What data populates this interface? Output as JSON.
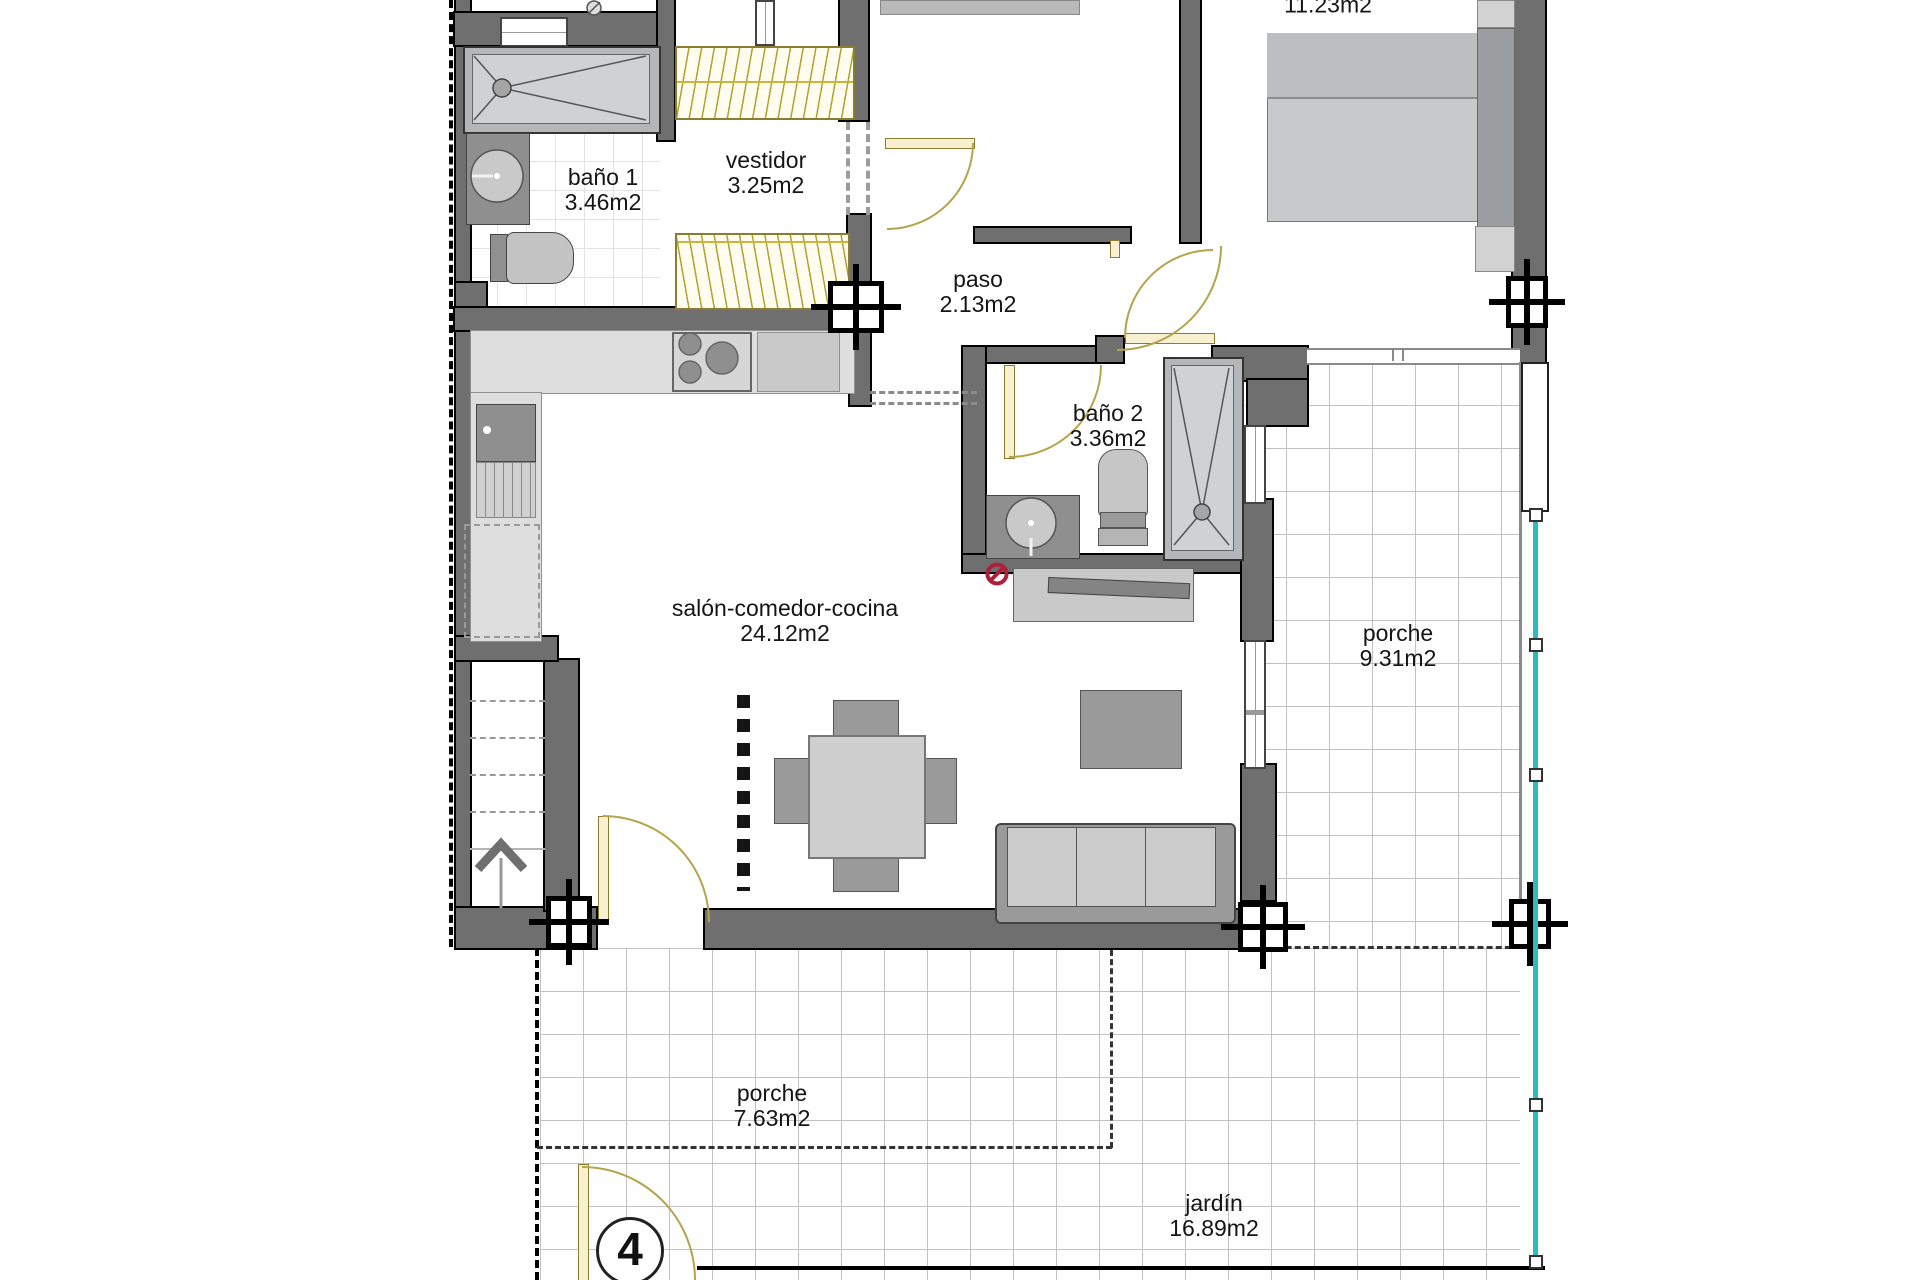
{
  "plan_title": "apartment floor plan",
  "rooms": {
    "bano1": {
      "name": "baño 1",
      "area": "3.46m2"
    },
    "vestidor": {
      "name": "vestidor",
      "area": "3.25m2"
    },
    "paso": {
      "name": "paso",
      "area": "2.13m2"
    },
    "dormitorio": {
      "area": "11.23m2"
    },
    "bano2": {
      "name": "baño 2",
      "area": "3.36m2"
    },
    "salon": {
      "name": "salón-comedor-cocina",
      "area": "24.12m2"
    },
    "porche_lateral": {
      "name": "porche",
      "area": "9.31m2"
    },
    "porche_frontal": {
      "name": "porche",
      "area": "7.63m2"
    },
    "jardin": {
      "name": "jardín",
      "area": "16.89m2"
    }
  },
  "unit_number": "4",
  "colors": {
    "wall": "#6f6f6f",
    "door_accent": "#b5a44a",
    "railing": "#29bdbd",
    "no_entry": "#ad1f3a",
    "furniture_light": "#c9c9c9",
    "furniture_dark": "#8f8f8f"
  }
}
